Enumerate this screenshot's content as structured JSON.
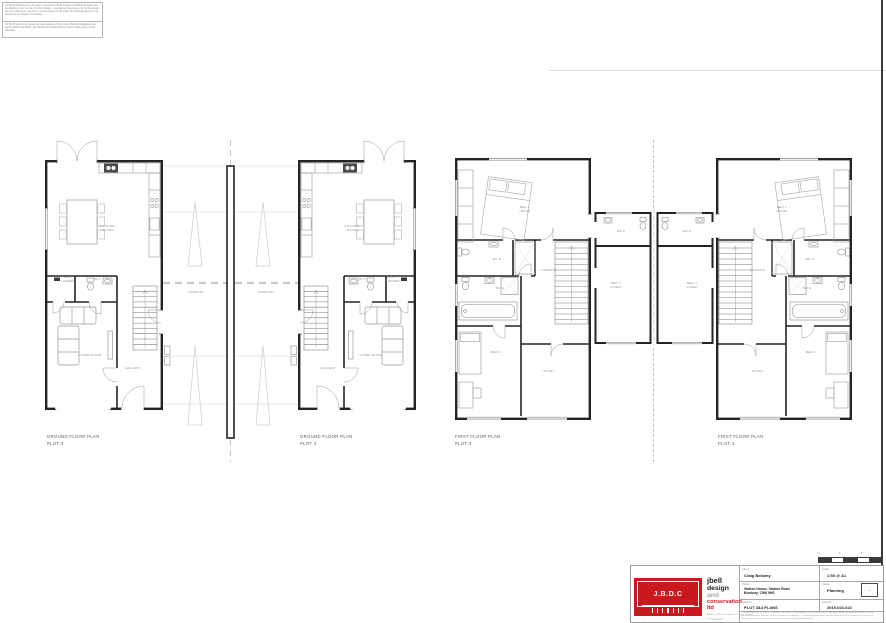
{
  "notes": {
    "note1": "NOTE: All drawings are to be read in conjunction with all relevant consultants drawings and specifications. Do not scale from this drawing — use figured dimensions only. All dimensions are to be checked on site prior to commencement of any works. Any discrepancies are to be reported to the designer immediately.",
    "note2": "NOTE: All works to be carried out in accordance with the current Building Regulations and relevant British Standards. All materials and workmanship to match existing unless noted otherwise."
  },
  "plan_titles": {
    "ground": "GROUND FLOOR PLAN",
    "first": "FIRST FLOOR PLAN",
    "plot3": "PLOT 3",
    "plot4": "PLOT 4"
  },
  "rooms_ground": {
    "kitchen1": "KITCHEN /",
    "kitchen2": "DINING",
    "plant1": "PLANT /",
    "plant2": "LARDER",
    "wc": "W.C.",
    "living": "LIVING ROOM",
    "hall": "HALLWAY"
  },
  "carport_label": "CARPORT",
  "rooms_first": {
    "bed1a": "BED 1",
    "bed1b": "(MAIN)",
    "ens": "EN-S",
    "landing": "LANDING",
    "bath": "BATH",
    "bed2": "BED 2",
    "study": "STUDY"
  },
  "rooms_link": {
    "ens": "EN-S",
    "bed4a": "BED 4",
    "bed4b": "(OVER)"
  },
  "titleblock": {
    "logo_acronym": "J.B.D.C",
    "company_name_1": "jbell",
    "company_name_2a": "design",
    "company_name_2b": " and",
    "company_name_3": "conservation ltd",
    "address_line": "Address: Holly Trees Business Centre, Cheshire",
    "phone_line": "T: 01829 752744",
    "email_line": "E: jb@jbelldesignandconservation.co.uk",
    "client_label": "Client:",
    "client_value": "Craig Bellamy",
    "project_label": "Project:",
    "project_value_1": "Station House, Station Road",
    "project_value_2": "Bunbury, CW6 9HS",
    "drawing_label": "Drawing:",
    "drawing_value": "PLOT 3&4 PLANS",
    "scale_label": "Scale:",
    "scale_value": "1:50 @ A1",
    "status_label": "Status:",
    "status_value": "Planning",
    "dwg_label": "Dwg No:",
    "dwg_value": "2019-023-022",
    "revision": "-",
    "copyright": "© THIS DRAWING IS THE COPYRIGHT OF J BELL DESIGN AND CONSERVATION LTD and must not be reproduced in whole or in part without prior written consent. Do not scale from this drawing — use figured dimensions only. All dimensions to be checked on site prior to commencement of any works and any discrepancies reported immediately.",
    "scalebar": {
      "n0": "0",
      "n1": "1",
      "n2": "2",
      "unit": "m"
    }
  }
}
